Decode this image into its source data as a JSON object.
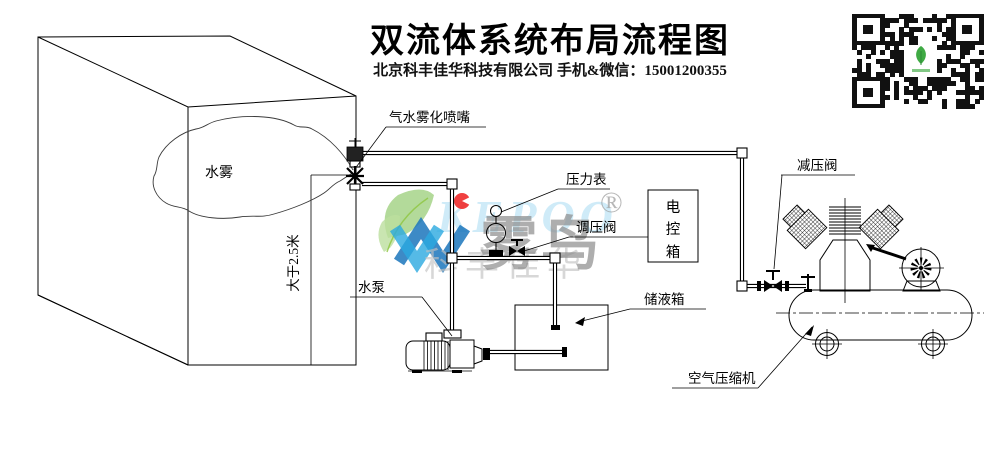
{
  "header": {
    "title": "双流体系统布局流程图",
    "subtitle": "北京科丰佳华科技有限公司 手机&微信：15001200355"
  },
  "labels": {
    "nozzle": "气水雾化喷嘴",
    "mist": "水雾",
    "distance": "大于2.5米",
    "pressure_gauge": "压力表",
    "regulating_valve": "调压阀",
    "control_box_chars": [
      "电",
      "控",
      "箱"
    ],
    "water_pump": "水泵",
    "liquid_tank": "储液箱",
    "relief_valve": "减压阀",
    "air_compressor": "空气压缩机"
  },
  "watermark": {
    "latin": "KEPOO",
    "brand": "雾鸟",
    "reg": "®",
    "company": "科丰佳华"
  },
  "colors": {
    "line": "#000000",
    "watermark_gray": "#8f8f8f",
    "logo_blue": "#2aa9e0",
    "logo_dark_blue": "#1b75bc",
    "logo_green": "#8dc63f",
    "logo_red": "#ee2b2b"
  }
}
